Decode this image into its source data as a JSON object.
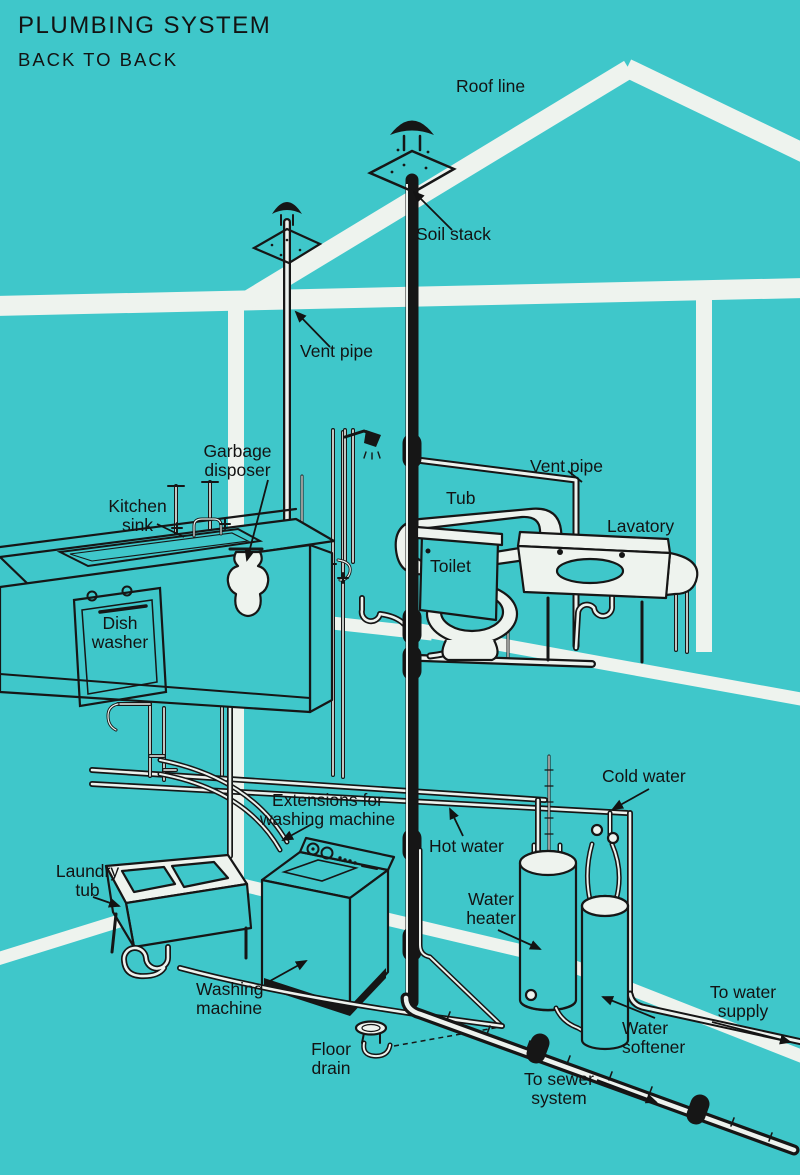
{
  "title": {
    "line1": "PLUMBING SYSTEM",
    "line2": "BACK TO BACK"
  },
  "labels": {
    "roof_line": "Roof line",
    "soil_stack": "Soil stack",
    "vent_pipe_upper": "Vent pipe",
    "vent_pipe_bathroom": "Vent pipe",
    "garbage_disposer": "Garbage\ndisposer",
    "kitchen_sink": "Kitchen\nsink",
    "tub": "Tub",
    "toilet": "Toilet",
    "lavatory": "Lavatory",
    "dish_washer": "Dish\nwasher",
    "extensions_for_washing_machine": "Extensions for\nwashing machine",
    "hot_water": "Hot water",
    "cold_water": "Cold water",
    "water_heater": "Water\nheater",
    "laundry_tub": "Laundry\ntub",
    "washing_machine": "Washing\nmachine",
    "water_softener": "Water\nsoftener",
    "to_water_supply": "To water\nsupply",
    "floor_drain": "Floor\ndrain",
    "to_sewer_system": "To sewer\nsystem"
  },
  "colors": {
    "background": "#3fc7ca",
    "structure_white": "#eef3ee",
    "line_ink": "#161616"
  }
}
